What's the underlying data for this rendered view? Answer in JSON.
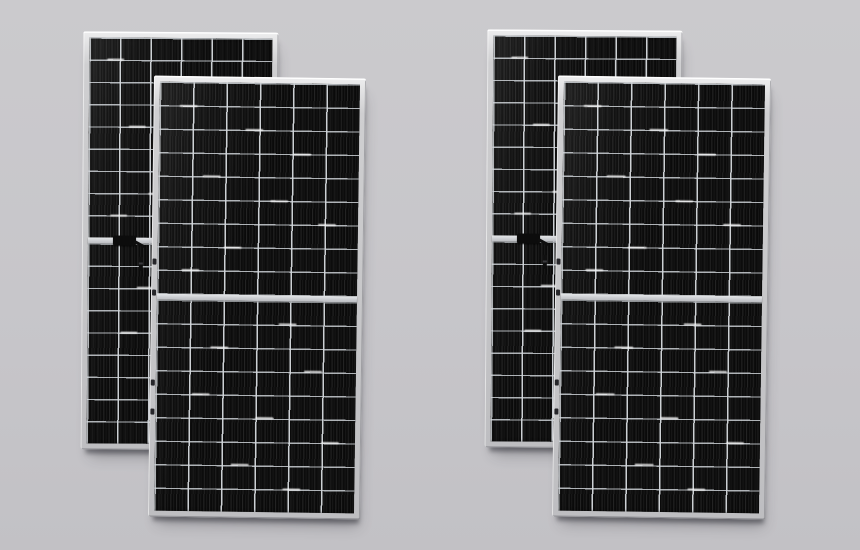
{
  "scene": {
    "description": "Product photograph of four framed half-cut monocrystalline solar panels standing upright on a plain light-gray studio background, arranged as two overlapping pairs; in each pair one panel sits behind and offset up-left of the front panel",
    "panel_count": 4,
    "arrangement": "two overlapping pairs",
    "background": {
      "top": "#cbcacd",
      "middle": "#c7c6ca",
      "bottom": "#c2c1c5"
    },
    "colors": {
      "frame_highlight": "#f2f2f2",
      "frame_silver": "#c6c6c8",
      "frame_shade": "#9b9b9f",
      "cell_black": "#0d0d0d",
      "cell_stripe": "#161616",
      "grid_line": "#d6dade",
      "center_rail": "#ccced2",
      "junction_box": "#0c0c0c",
      "drop_shadow": "rgba(55,55,62,0.55)"
    },
    "panel_spec": {
      "cell_columns": 6,
      "cell_rows_per_half": 9,
      "halves": 2,
      "cell_type": "half-cut monocrystalline, near-black cells with thin light gridlines and fine vertical finger lines",
      "frame": "silver aluminum frame with bright top highlight",
      "center_rail": "light horizontal rail splitting the module into two half-cell sections"
    },
    "panels": [
      {
        "id": "back-left",
        "x": 82,
        "y": 32,
        "w": 195,
        "h": 418,
        "z": 1,
        "tilt_deg": 0.4,
        "columns": 6,
        "rows_per_half": 9,
        "junction_box": true,
        "junction_box_note": "black junction box with short cable and hanging connector on the center rail"
      },
      {
        "id": "front-left",
        "x": 151,
        "y": 77,
        "w": 212,
        "h": 441,
        "z": 2,
        "tilt_deg": 0.8,
        "columns": 6,
        "rows_per_half": 9,
        "junction_box": false
      },
      {
        "id": "back-right",
        "x": 486,
        "y": 30,
        "w": 195,
        "h": 418,
        "z": 1,
        "tilt_deg": 0.4,
        "columns": 6,
        "rows_per_half": 9,
        "junction_box": true,
        "junction_box_note": "black junction box with short cable and hanging connector on the center rail"
      },
      {
        "id": "front-right",
        "x": 555,
        "y": 77,
        "w": 213,
        "h": 441,
        "z": 2,
        "tilt_deg": 0.8,
        "columns": 6,
        "rows_per_half": 9,
        "junction_box": false
      }
    ]
  }
}
